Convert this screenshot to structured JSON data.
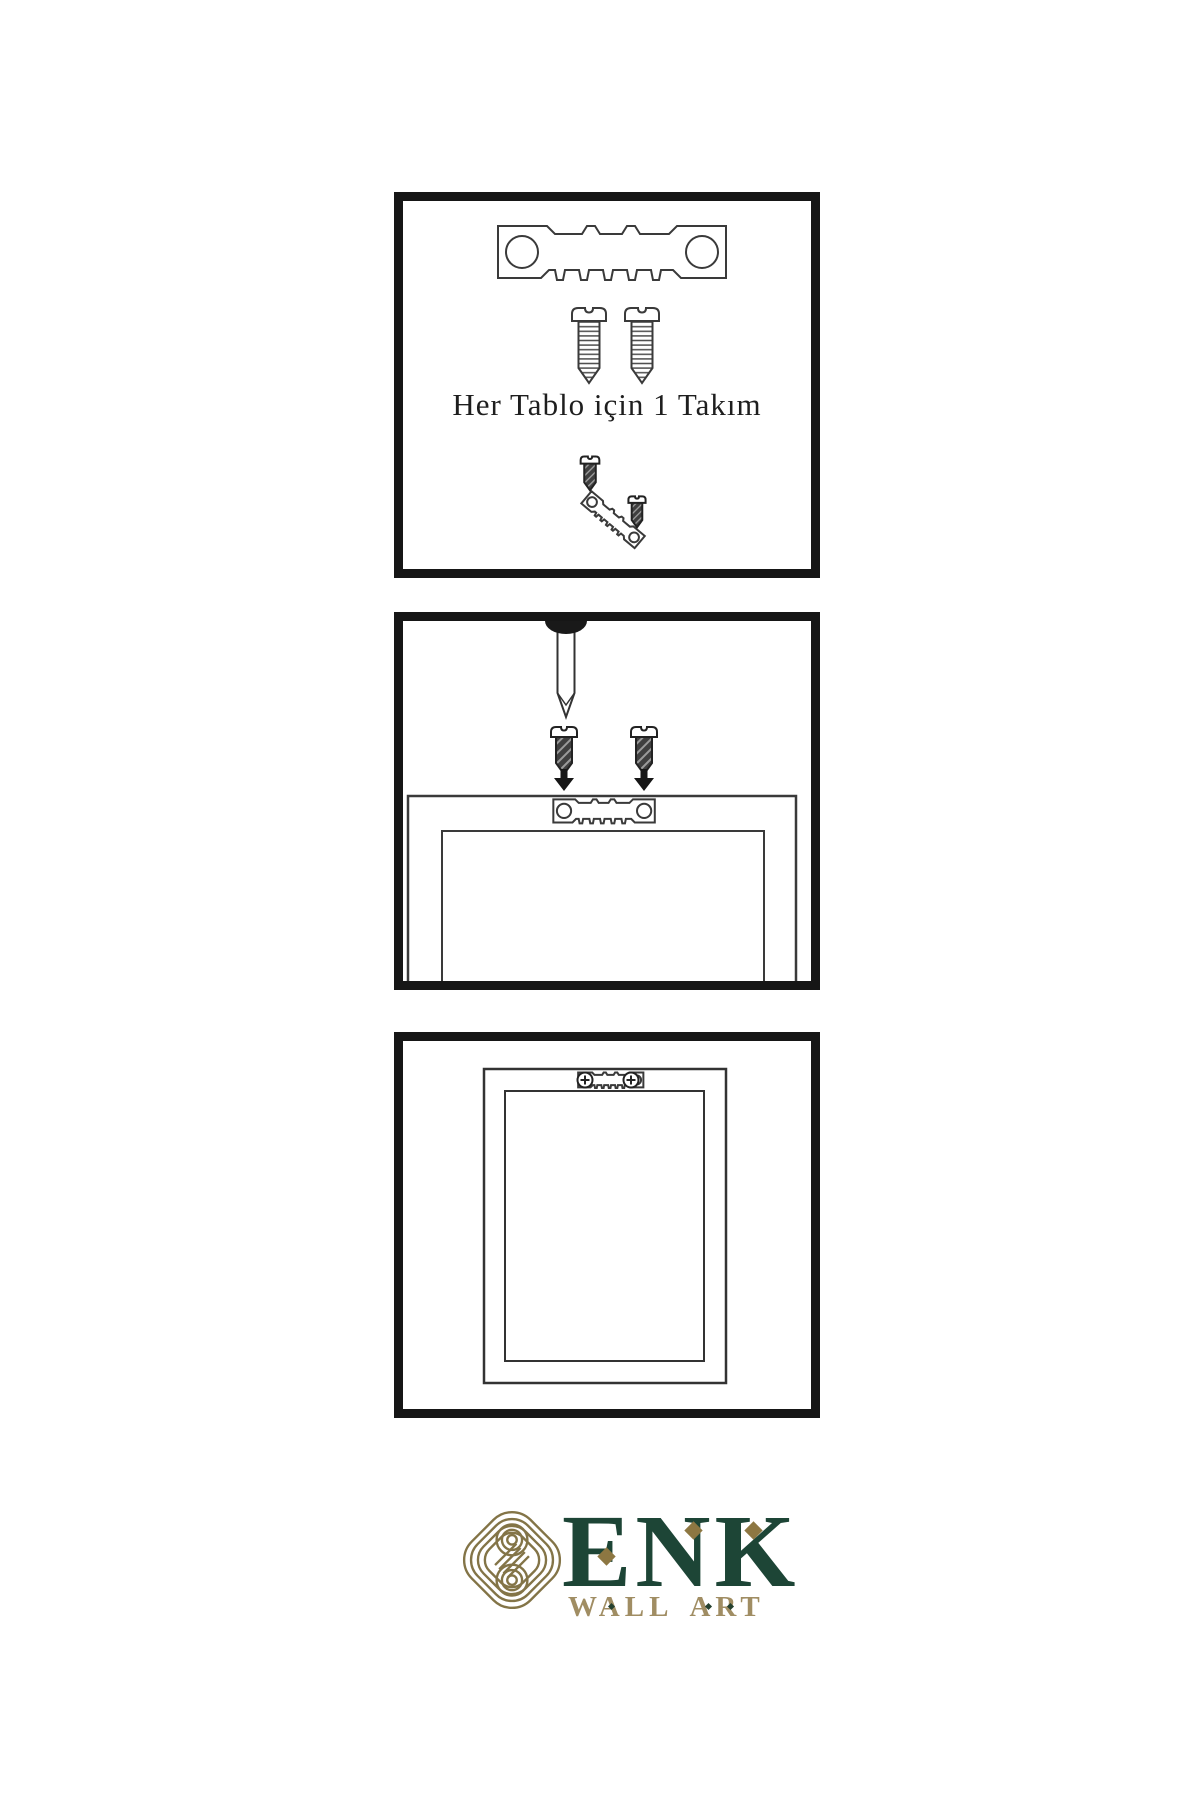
{
  "page": {
    "background": "#ffffff"
  },
  "palette": {
    "ink": "#161616",
    "line_art": "#3a3a3a",
    "brand_green": "#1d4536",
    "knot_gold": "#837447",
    "accent_gold": "#8d7742",
    "subtitle_gold": "#a08d63"
  },
  "steps": [
    {
      "name": "hardware-kit",
      "caption": "Her Tablo için 1 Takım",
      "icons": [
        "sawtooth-hanger-icon",
        "screw-icon",
        "screw-icon",
        "dark-screw-icon",
        "angled-sawtooth-hanger-icon",
        "dark-screw-icon"
      ]
    },
    {
      "name": "screw-hanger-to-frame",
      "icons": [
        "nail-icon",
        "dark-screw-icon",
        "dark-screw-icon",
        "arrow-down-icon",
        "arrow-down-icon",
        "sawtooth-hanger-icon",
        "frame-back-icon"
      ]
    },
    {
      "name": "hanger-mounted-on-frame",
      "icons": [
        "frame-back-icon",
        "sawtooth-hanger-icon",
        "phillips-screw-icon",
        "phillips-screw-icon"
      ]
    }
  ],
  "logo": {
    "brand": "ENK",
    "subtitle": "WALL ART",
    "icon": "knot-logo-icon"
  }
}
